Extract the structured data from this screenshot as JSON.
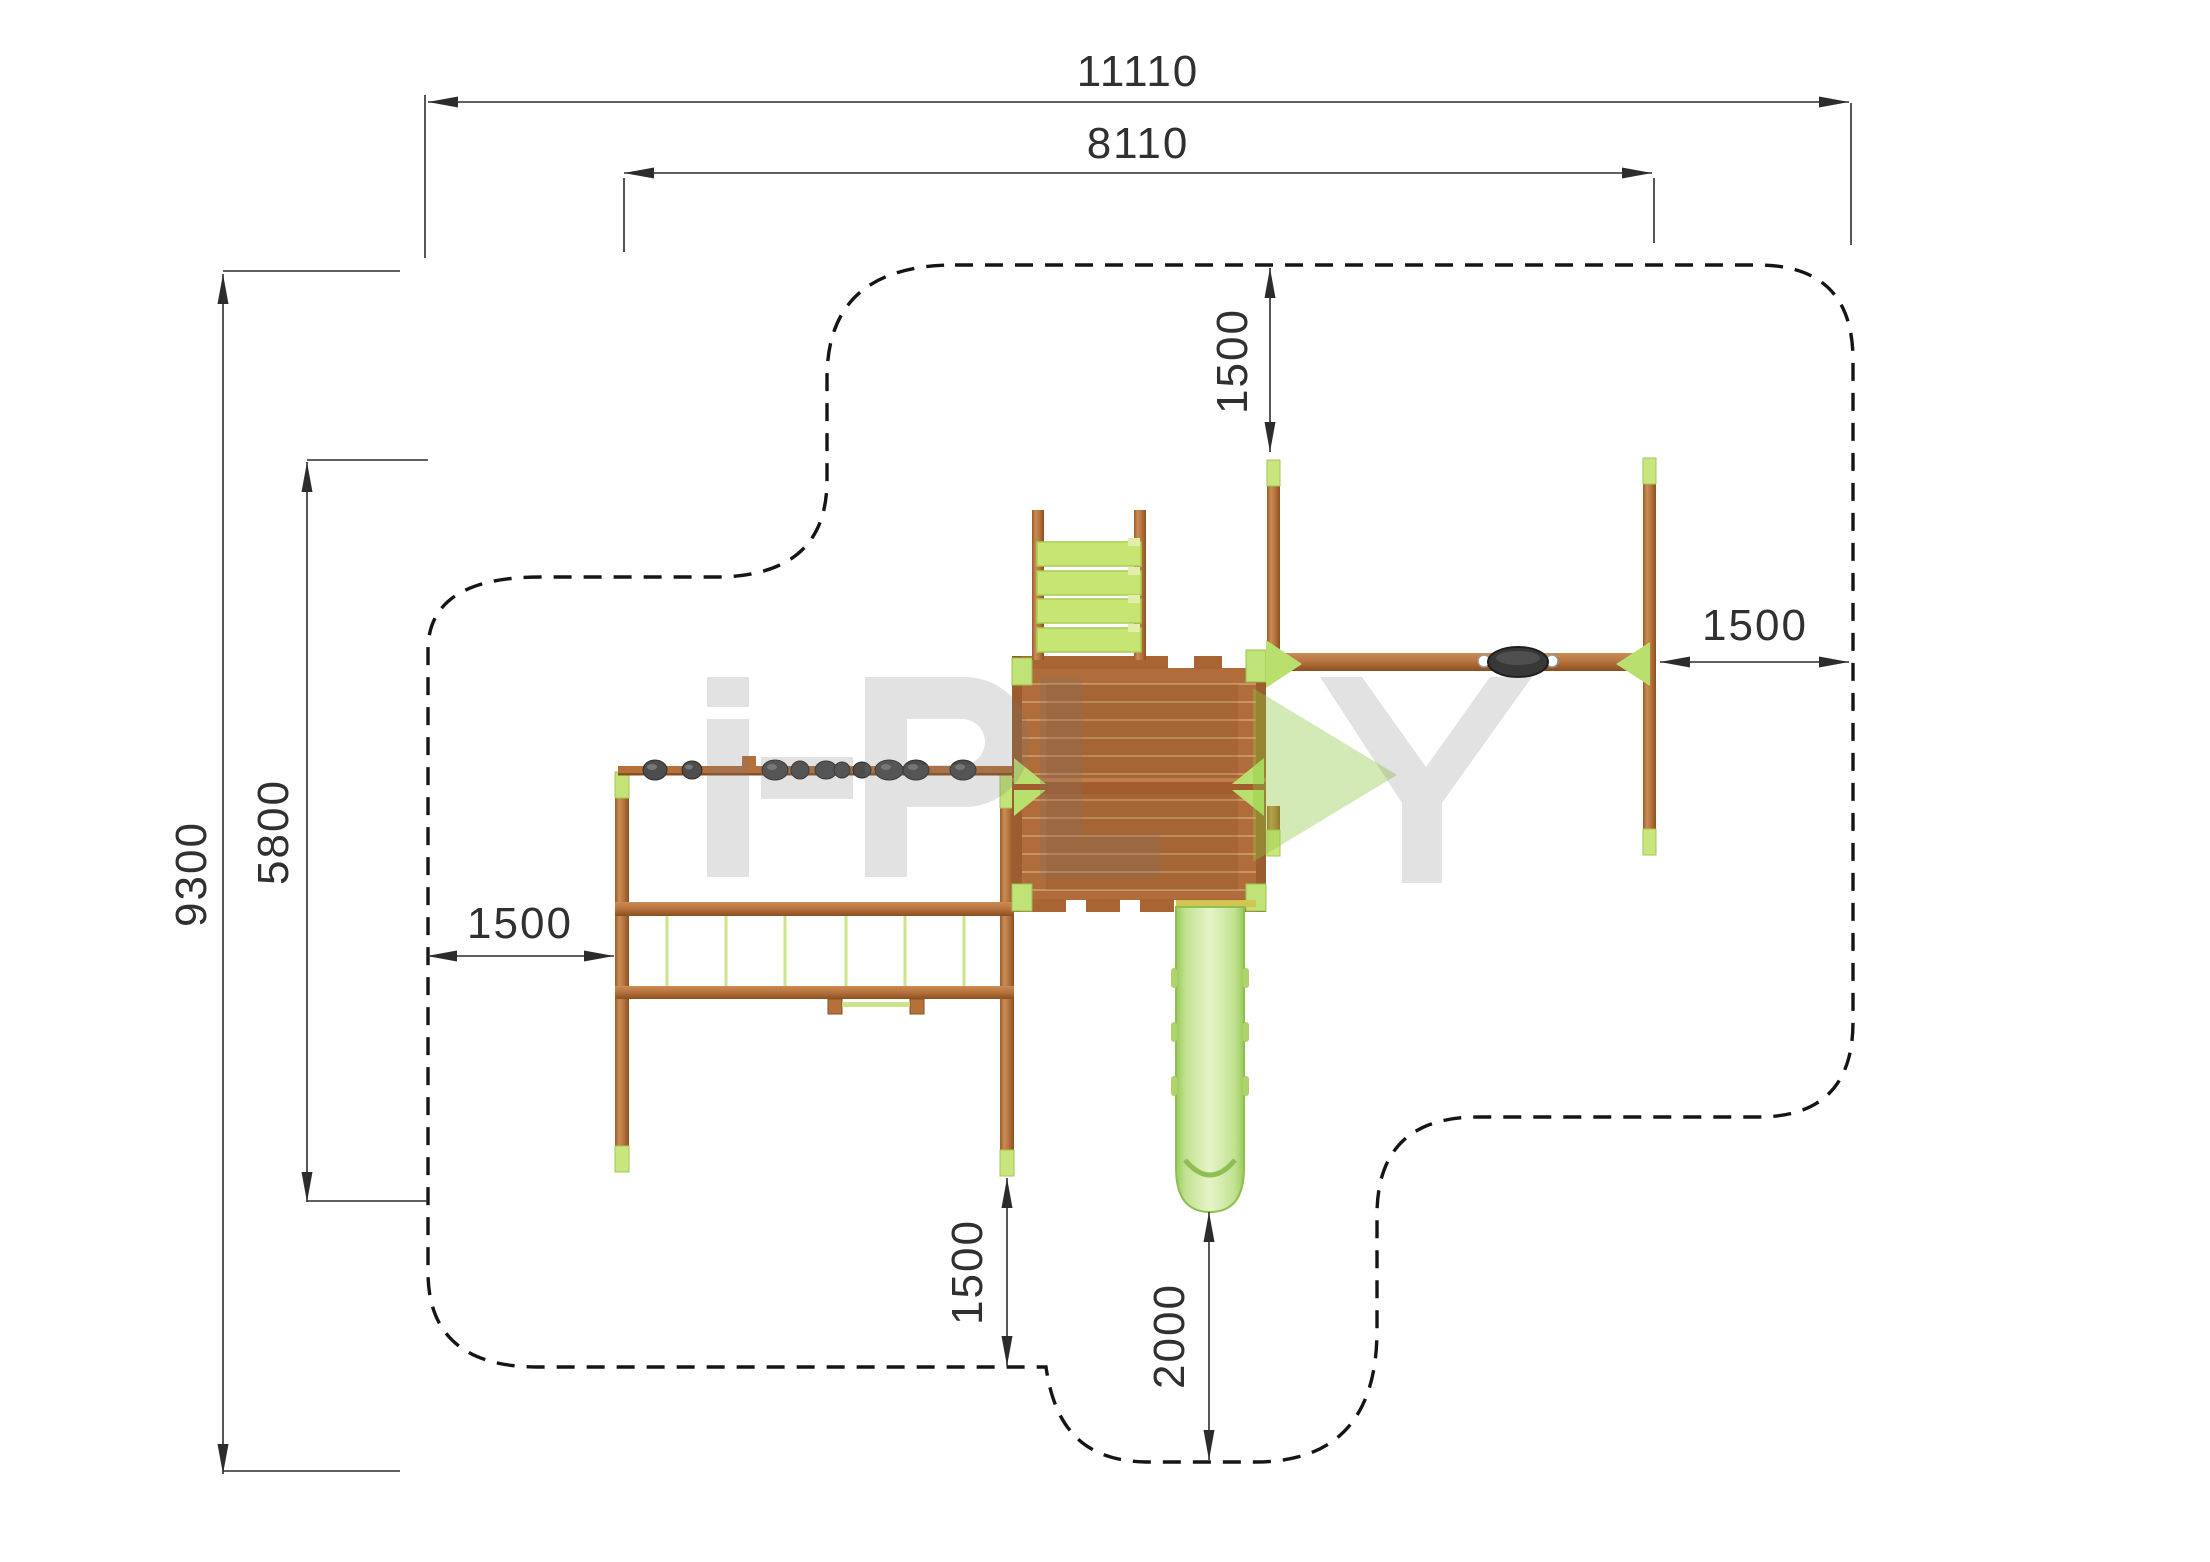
{
  "drawing": {
    "type": "playground safety zone plan (top view)",
    "watermark_brand": "i-PLAY"
  },
  "dimensions": {
    "overall_width": {
      "label": "11110",
      "orientation": "horizontal"
    },
    "frame_width": {
      "label": "8110",
      "orientation": "horizontal"
    },
    "overall_depth": {
      "label": "9300",
      "orientation": "vertical"
    },
    "frame_depth": {
      "label": "5800",
      "orientation": "vertical"
    },
    "clearance_top": {
      "label": "1500",
      "orientation": "vertical"
    },
    "clearance_right": {
      "label": "1500",
      "orientation": "horizontal"
    },
    "clearance_left": {
      "label": "1500",
      "orientation": "horizontal"
    },
    "clearance_bottom": {
      "label": "1500",
      "orientation": "vertical"
    },
    "slide_runout": {
      "label": "2000",
      "orientation": "vertical"
    }
  },
  "components": [
    "platform deck",
    "climbing ladder",
    "monkey bar with grip knobs",
    "swing beam with seat",
    "slide",
    "balance rails with net",
    "safety zone boundary"
  ],
  "colors": {
    "wood_main": "#b5713c",
    "wood_dark": "#8e5223",
    "wood_light": "#c98a52",
    "accent_green": "#c3e377",
    "slide_green": "#cfe9a4",
    "slide_rail": "#9cc95d",
    "seat_gray": "#383838",
    "boundary_black": "#151515",
    "dim_line": "#2c2c2c",
    "watermark_gray": "#e1e1e1",
    "watermark_green": "#d4eab6"
  }
}
